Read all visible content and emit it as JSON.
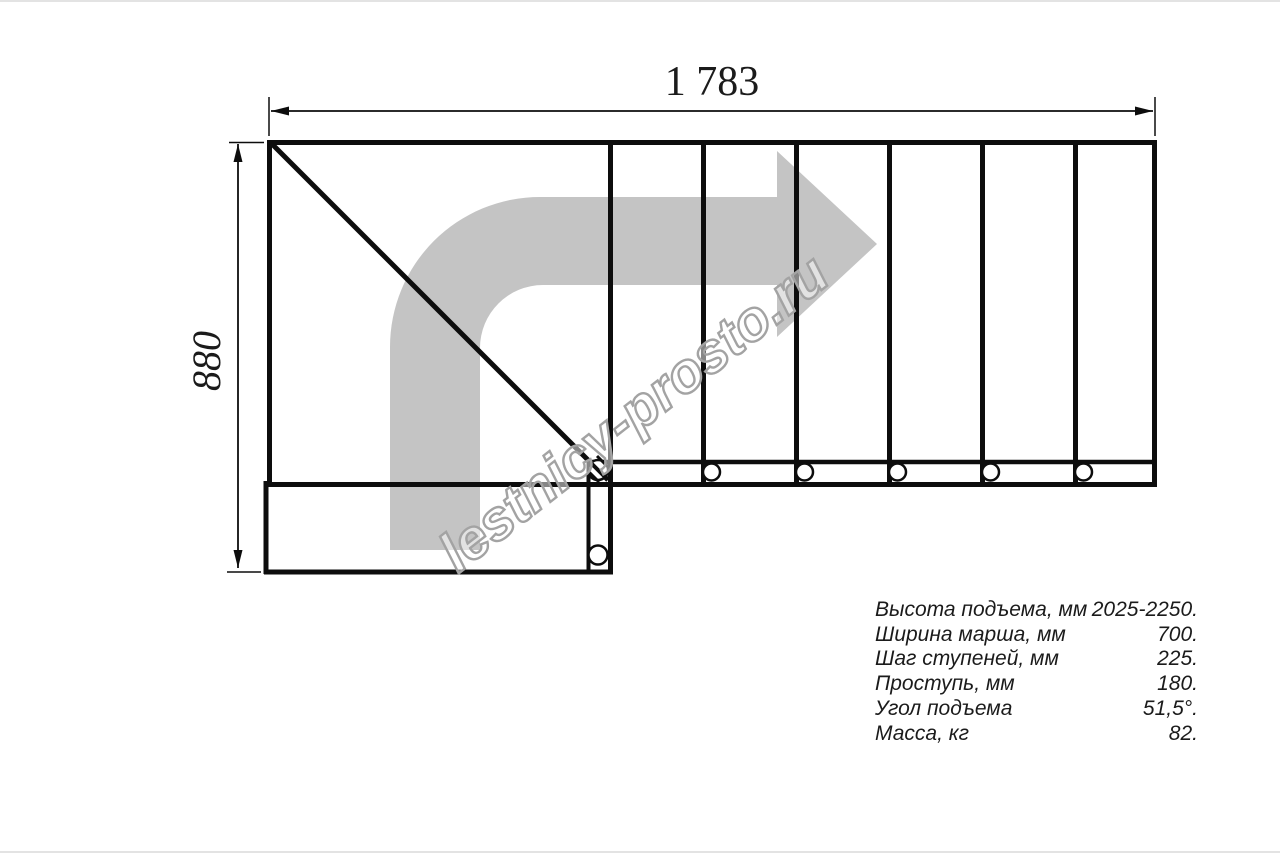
{
  "title": "Staircase plan drawing",
  "dimensions": {
    "top_label": "1 783",
    "left_label": "880"
  },
  "watermark": "lestnicy-prosto.ru",
  "specs": {
    "rows": [
      {
        "label": "Высота подъема, мм",
        "value": "2025-2250."
      },
      {
        "label": "Ширина марша, мм",
        "value": "700."
      },
      {
        "label": "Шаг ступеней, мм",
        "value": "225."
      },
      {
        "label": "Проступь, мм",
        "value": "180."
      },
      {
        "label": "Угол подъема",
        "value": "51,5°."
      },
      {
        "label": "Масса, кг",
        "value": "82."
      }
    ]
  },
  "colors": {
    "bg": "#ffffff",
    "line": "#0d0d0d",
    "arrow": "#c4c4c4",
    "watermark_stroke": "#a3a3a3",
    "text": "#1b1b1b"
  }
}
